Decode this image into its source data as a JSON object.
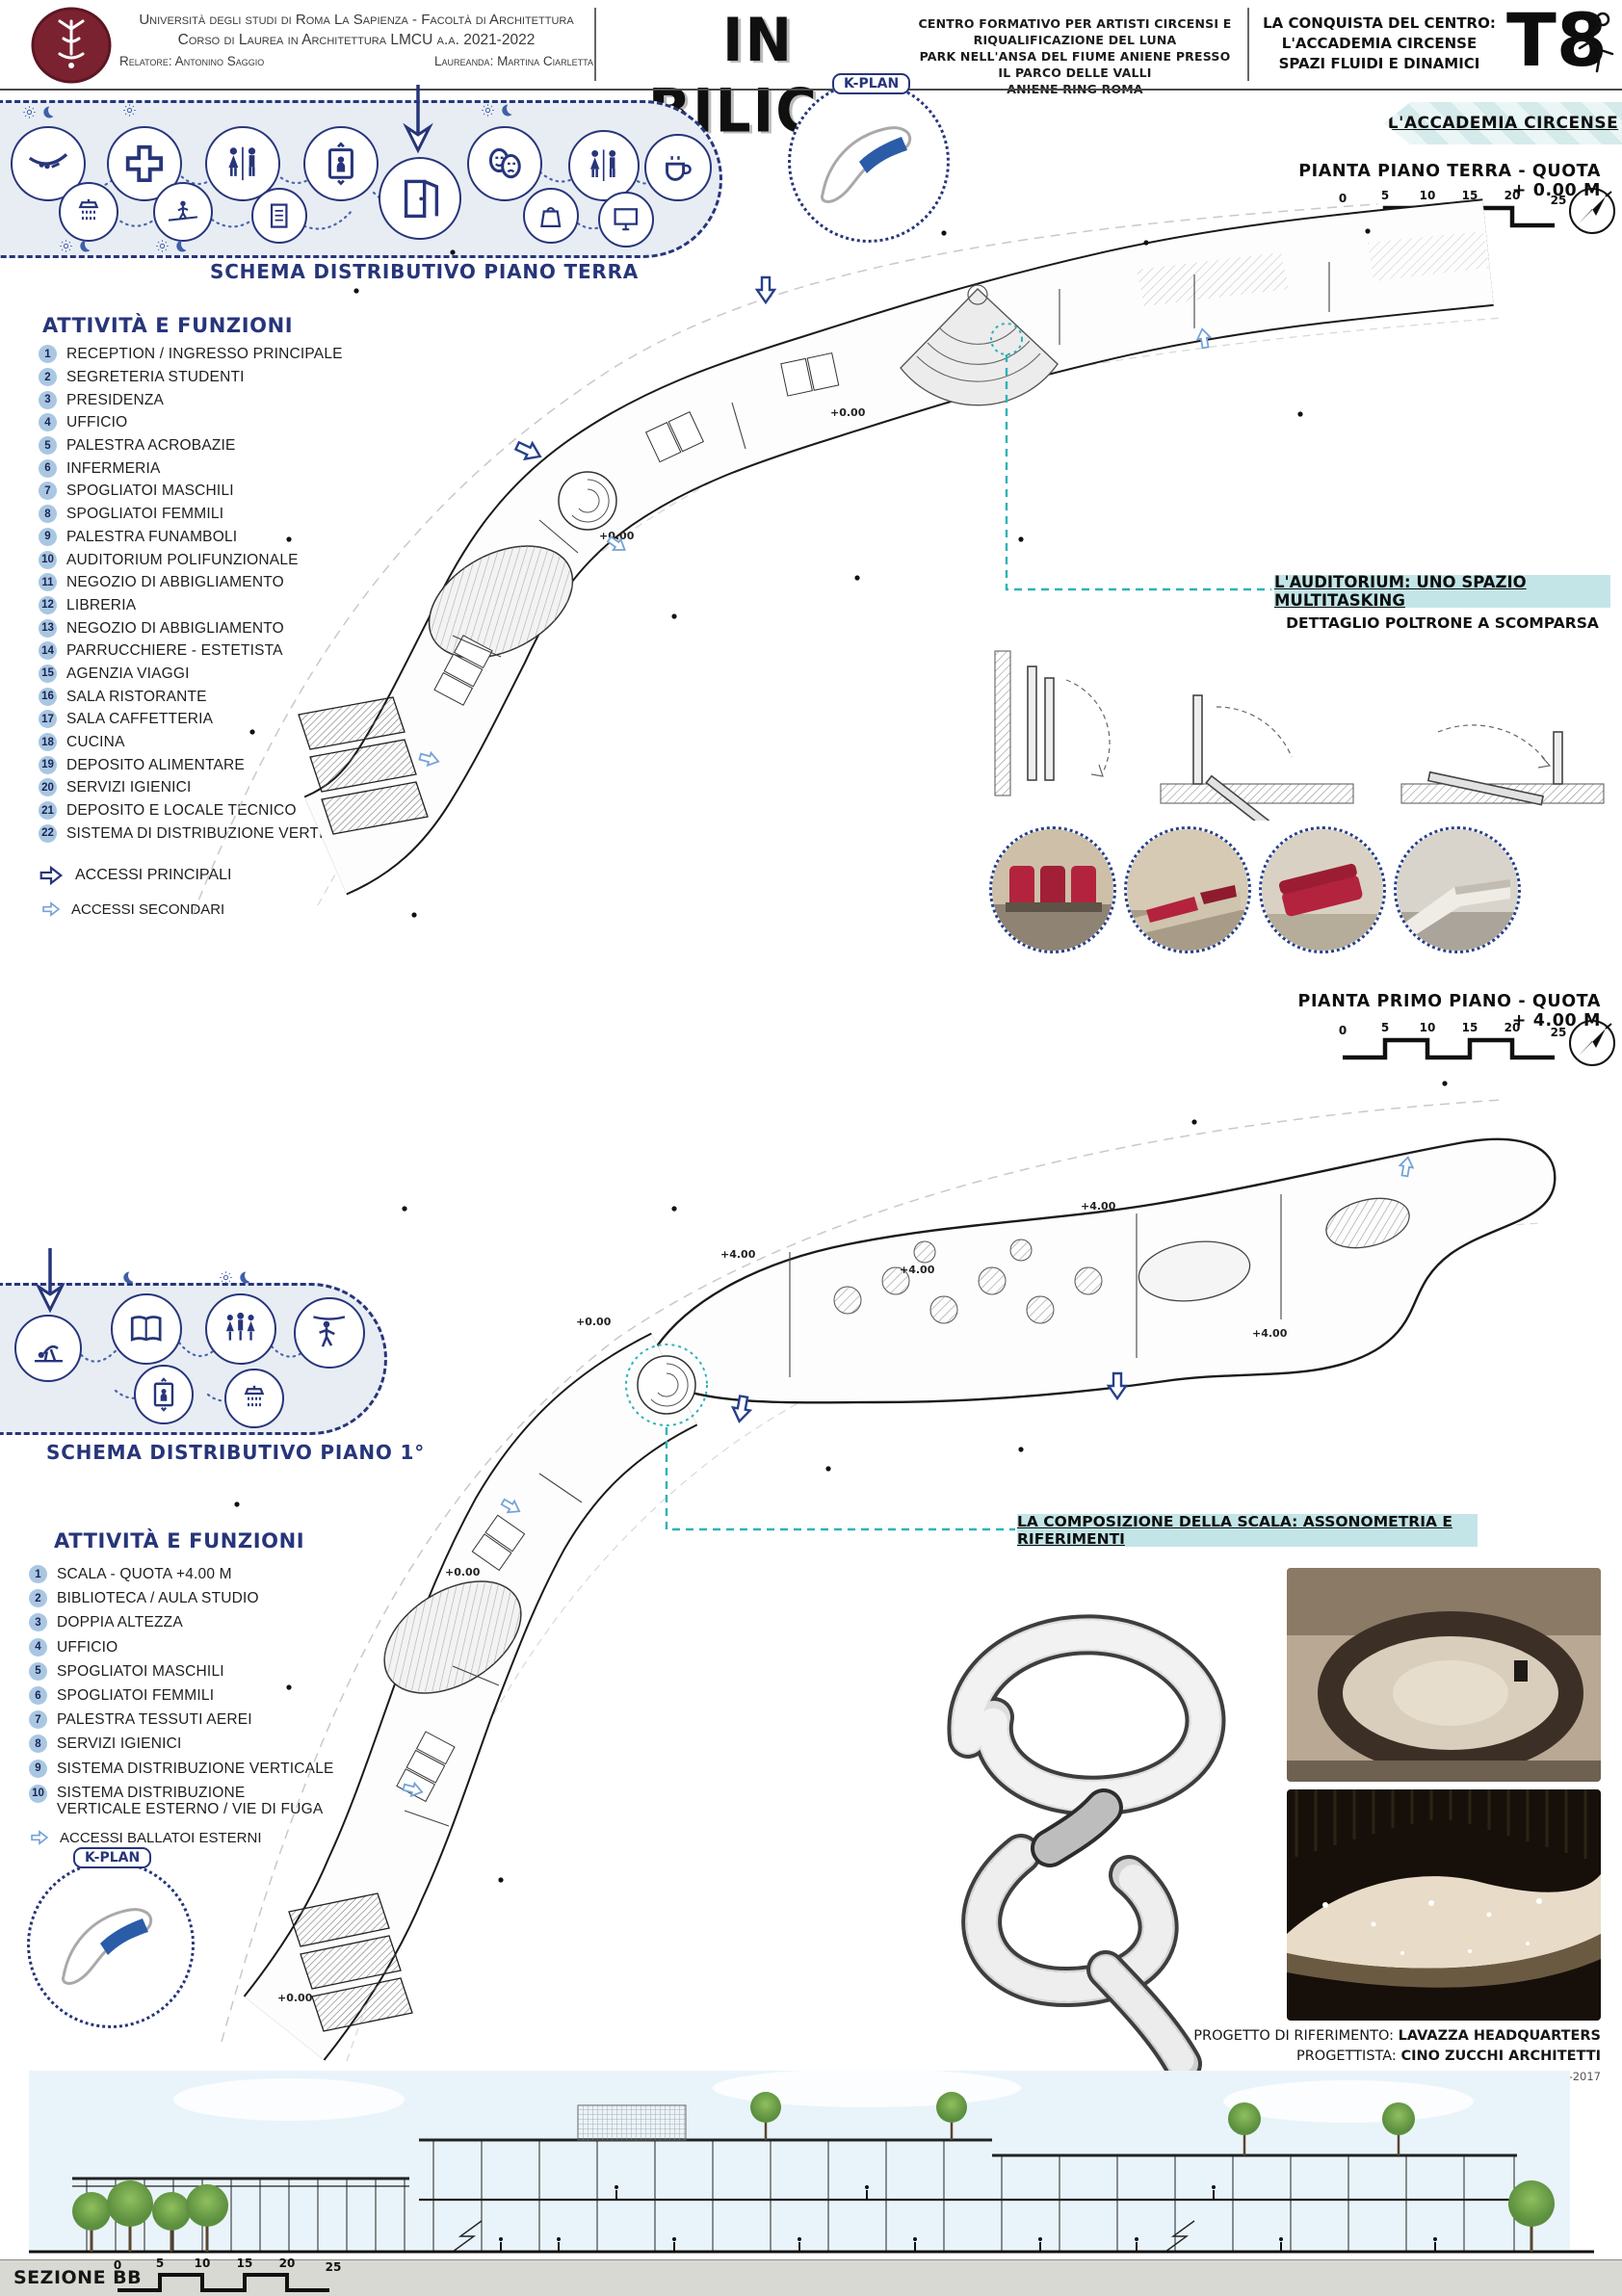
{
  "header": {
    "university_line1": "Università degli studi di Roma La Sapienza - Facoltà di Architettura",
    "university_line2": "Corso di Laurea in Architettura LMCU a.a. 2021-2022",
    "relatore": "Relatore: Antonino Saggio",
    "laureanda": "Laureanda: Martina Ciarletta",
    "title": "IN BILICO",
    "description_line1": "CENTRO FORMATIVO PER ARTISTI CIRCENSI E RIQUALIFICAZIONE DEL LUNA",
    "description_line2": "PARK NELL'ANSA DEL FIUME ANIENE PRESSO IL PARCO DELLE VALLI",
    "description_line3": "ANIENE RING ROMA",
    "project_line1": "LA CONQUISTA DEL CENTRO:",
    "project_line2": "L'ACCADEMIA CIRCENSE",
    "project_line3": "SPAZI FLUIDI E DINAMICI",
    "tavola": "T8"
  },
  "k_plan": {
    "label": "K-PLAN"
  },
  "schema_terra": {
    "title": "SCHEMA DISTRIBUTIVO PIANO TERRA",
    "icons": [
      "trapeze",
      "medical-cross",
      "wc",
      "elevator",
      "entrance-door",
      "theater-masks",
      "wc",
      "coffee",
      "shower",
      "tightrope-walker",
      "clipboard",
      "shopping-bag",
      "monitor"
    ],
    "day_night_icons": [
      "sun",
      "moon"
    ]
  },
  "attivita_terra": {
    "heading": "ATTIVITÀ E FUNZIONI",
    "items": [
      {
        "n": "1",
        "t": "RECEPTION / INGRESSO PRINCIPALE"
      },
      {
        "n": "2",
        "t": "SEGRETERIA STUDENTI"
      },
      {
        "n": "3",
        "t": "PRESIDENZA"
      },
      {
        "n": "4",
        "t": "UFFICIO"
      },
      {
        "n": "5",
        "t": "PALESTRA ACROBAZIE"
      },
      {
        "n": "6",
        "t": "INFERMERIA"
      },
      {
        "n": "7",
        "t": "SPOGLIATOI MASCHILI"
      },
      {
        "n": "8",
        "t": "SPOGLIATOI FEMMILI"
      },
      {
        "n": "9",
        "t": "PALESTRA FUNAMBOLI"
      },
      {
        "n": "10",
        "t": "AUDITORIUM POLIFUNZIONALE"
      },
      {
        "n": "11",
        "t": "NEGOZIO DI ABBIGLIAMENTO"
      },
      {
        "n": "12",
        "t": "LIBRERIA"
      },
      {
        "n": "13",
        "t": "NEGOZIO DI ABBIGLIAMENTO"
      },
      {
        "n": "14",
        "t": "PARRUCCHIERE - ESTETISTA"
      },
      {
        "n": "15",
        "t": "AGENZIA VIAGGI"
      },
      {
        "n": "16",
        "t": "SALA RISTORANTE"
      },
      {
        "n": "17",
        "t": "SALA CAFFETTERIA"
      },
      {
        "n": "18",
        "t": "CUCINA"
      },
      {
        "n": "19",
        "t": "DEPOSITO ALIMENTARE"
      },
      {
        "n": "20",
        "t": "SERVIZI IGIENICI"
      },
      {
        "n": "21",
        "t": "DEPOSITO E LOCALE TECNICO"
      },
      {
        "n": "22",
        "t": "SISTEMA DI DISTRIBUZIONE VERTICALE"
      }
    ],
    "accessi_principali": "ACCESSI PRINCIPALI",
    "accessi_secondari": "ACCESSI SECONDARI"
  },
  "plan_terra": {
    "banner": "L'ACCADEMIA CIRCENSE",
    "title": "PIANTA PIANO TERRA - QUOTA + 0.00 M",
    "quota": "+0.00"
  },
  "plan_primo": {
    "title": "PIANTA PRIMO PIANO - QUOTA + 4.00 M",
    "quota_alta": "+4.00",
    "quota_zero": "+0.00"
  },
  "scale_ticks": [
    "0",
    "5",
    "10",
    "15",
    "20",
    "25"
  ],
  "auditorium": {
    "title": "L'AUDITORIUM: UNO SPAZIO MULTITASKING",
    "subtitle": "DETTAGLIO POLTRONE A SCOMPARSA"
  },
  "schema_piano1": {
    "title": "SCHEMA DISTRIBUTIVO PIANO 1°",
    "icons": [
      "floor-acrobat",
      "book",
      "family-wc",
      "aerial-artist",
      "elevator",
      "shower"
    ]
  },
  "attivita_piano1": {
    "heading": "ATTIVITÀ E FUNZIONI",
    "items": [
      {
        "n": "1",
        "t": "SCALA - QUOTA +4.00 M"
      },
      {
        "n": "2",
        "t": "BIBLIOTECA / AULA STUDIO"
      },
      {
        "n": "3",
        "t": "DOPPIA ALTEZZA"
      },
      {
        "n": "4",
        "t": "UFFICIO"
      },
      {
        "n": "5",
        "t": "SPOGLIATOI MASCHILI"
      },
      {
        "n": "6",
        "t": "SPOGLIATOI FEMMILI"
      },
      {
        "n": "7",
        "t": "PALESTRA TESSUTI AEREI"
      },
      {
        "n": "8",
        "t": "SERVIZI IGIENICI"
      },
      {
        "n": "9",
        "t": "SISTEMA DISTRIBUZIONE VERTICALE"
      },
      {
        "n": "10",
        "t": "SISTEMA DISTRIBUZIONE VERTICALE ESTERNO / VIE DI FUGA"
      }
    ],
    "accessi_ballatoi": "ACCESSI BALLATOI ESTERNI"
  },
  "scala": {
    "banner": "LA COMPOSIZIONE DELLA SCALA: ASSONOMETRIA E RIFERIMENTI",
    "caption": {
      "ref_label": "PROGETTO DI RIFERIMENTO:",
      "ref_value": "LAVAZZA HEADQUARTERS",
      "arch_label": "PROGETTISTA:",
      "arch_value": "CINO ZUCCHI ARCHITETTI",
      "anno": "ANNO: 2010-2017"
    }
  },
  "sezione": {
    "label": "SEZIONE BB"
  },
  "colors": {
    "navy": "#27357a",
    "teal_banner": "#c3e5e7",
    "teal_line": "#2fb3b7",
    "accent_blue": "#4a7cc9",
    "maroon": "#7b2230",
    "seat_red": "#b3233d"
  }
}
